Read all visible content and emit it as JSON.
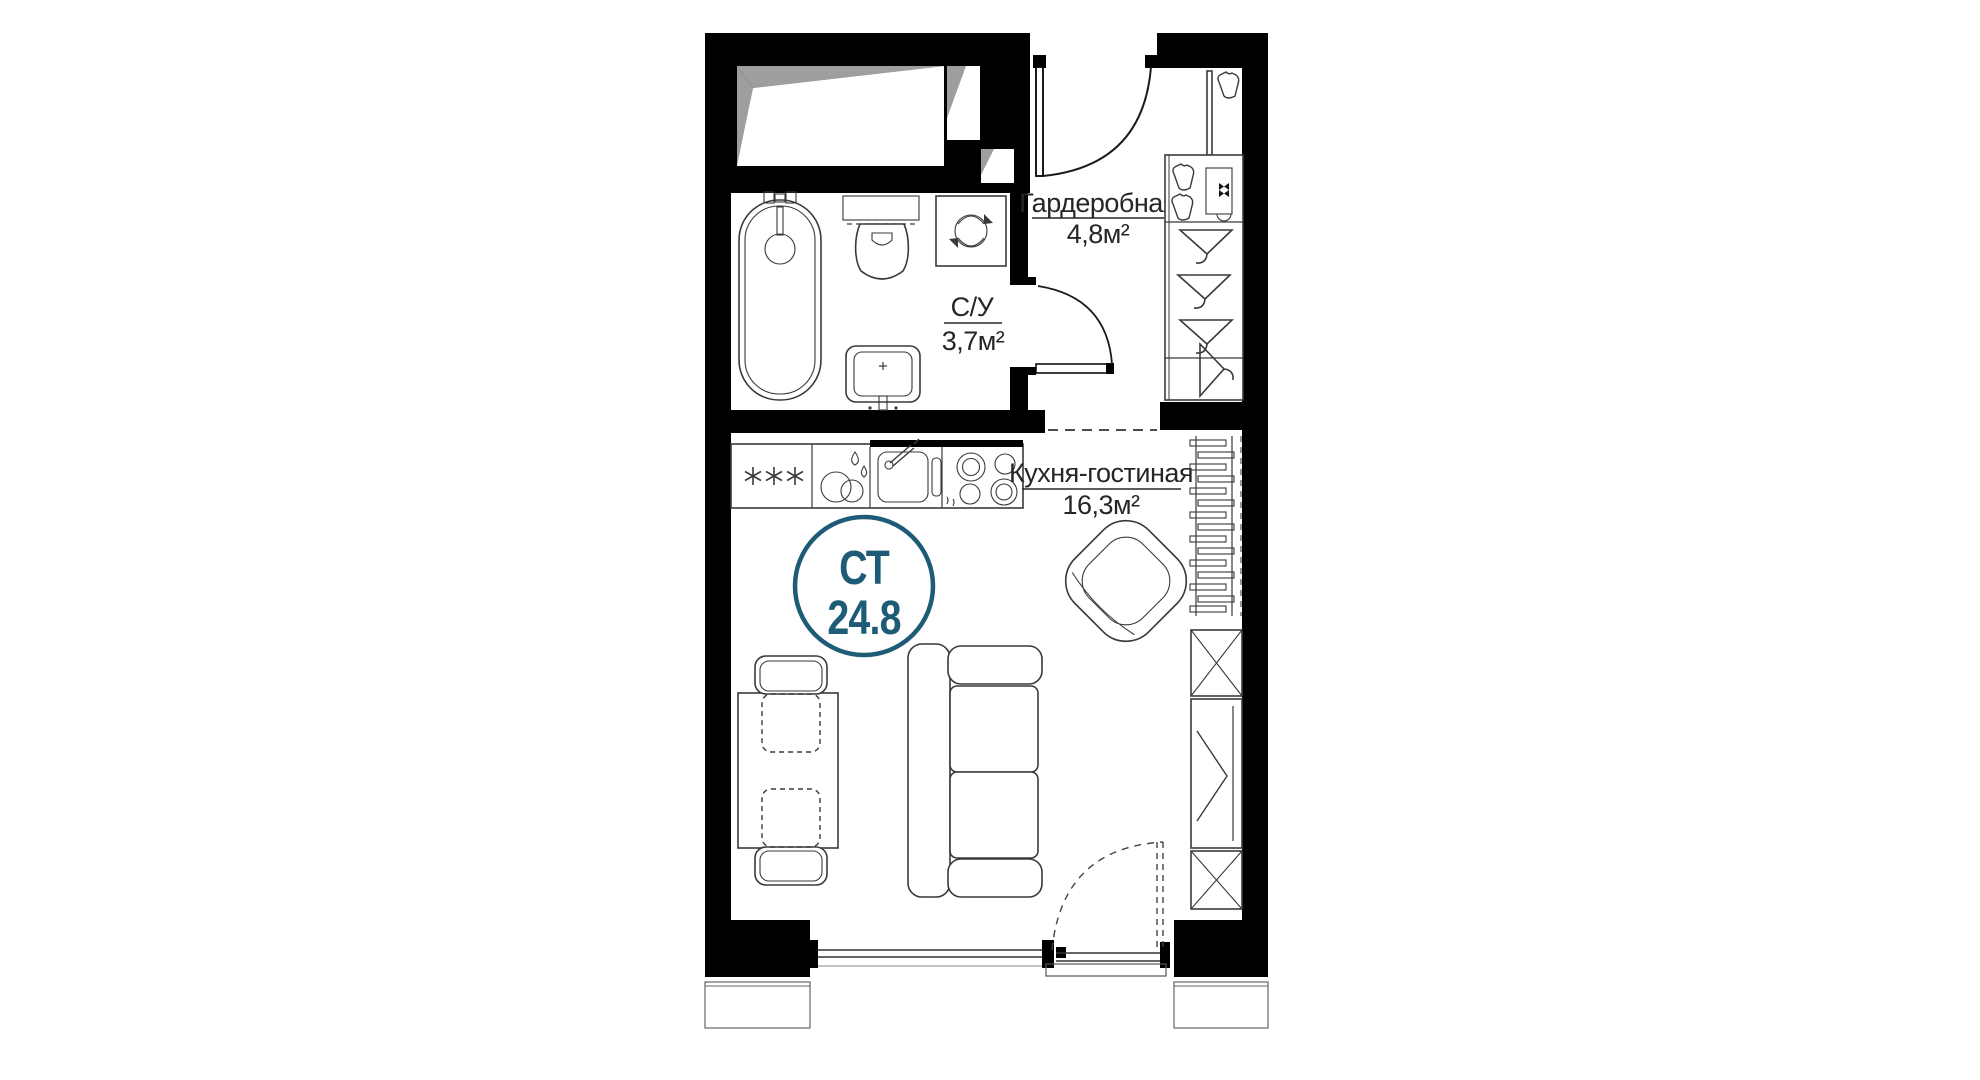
{
  "floor_plan": {
    "badge": {
      "type_label": "СТ",
      "area_value": "24.8"
    },
    "rooms": {
      "wardrobe": {
        "name": "Гардеробная",
        "area": "4,8м²"
      },
      "bathroom": {
        "name": "С/У",
        "area": "3,7м²"
      },
      "kitchen_living": {
        "name": "Кухня-гостиная",
        "area": "16,3м²"
      }
    },
    "colors": {
      "accent_teal": "#1e5b76",
      "wall_black": "#000000",
      "furniture_line": "#3a3a3a",
      "shadow_gray": "#9e9e9e",
      "background": "#ffffff"
    }
  }
}
